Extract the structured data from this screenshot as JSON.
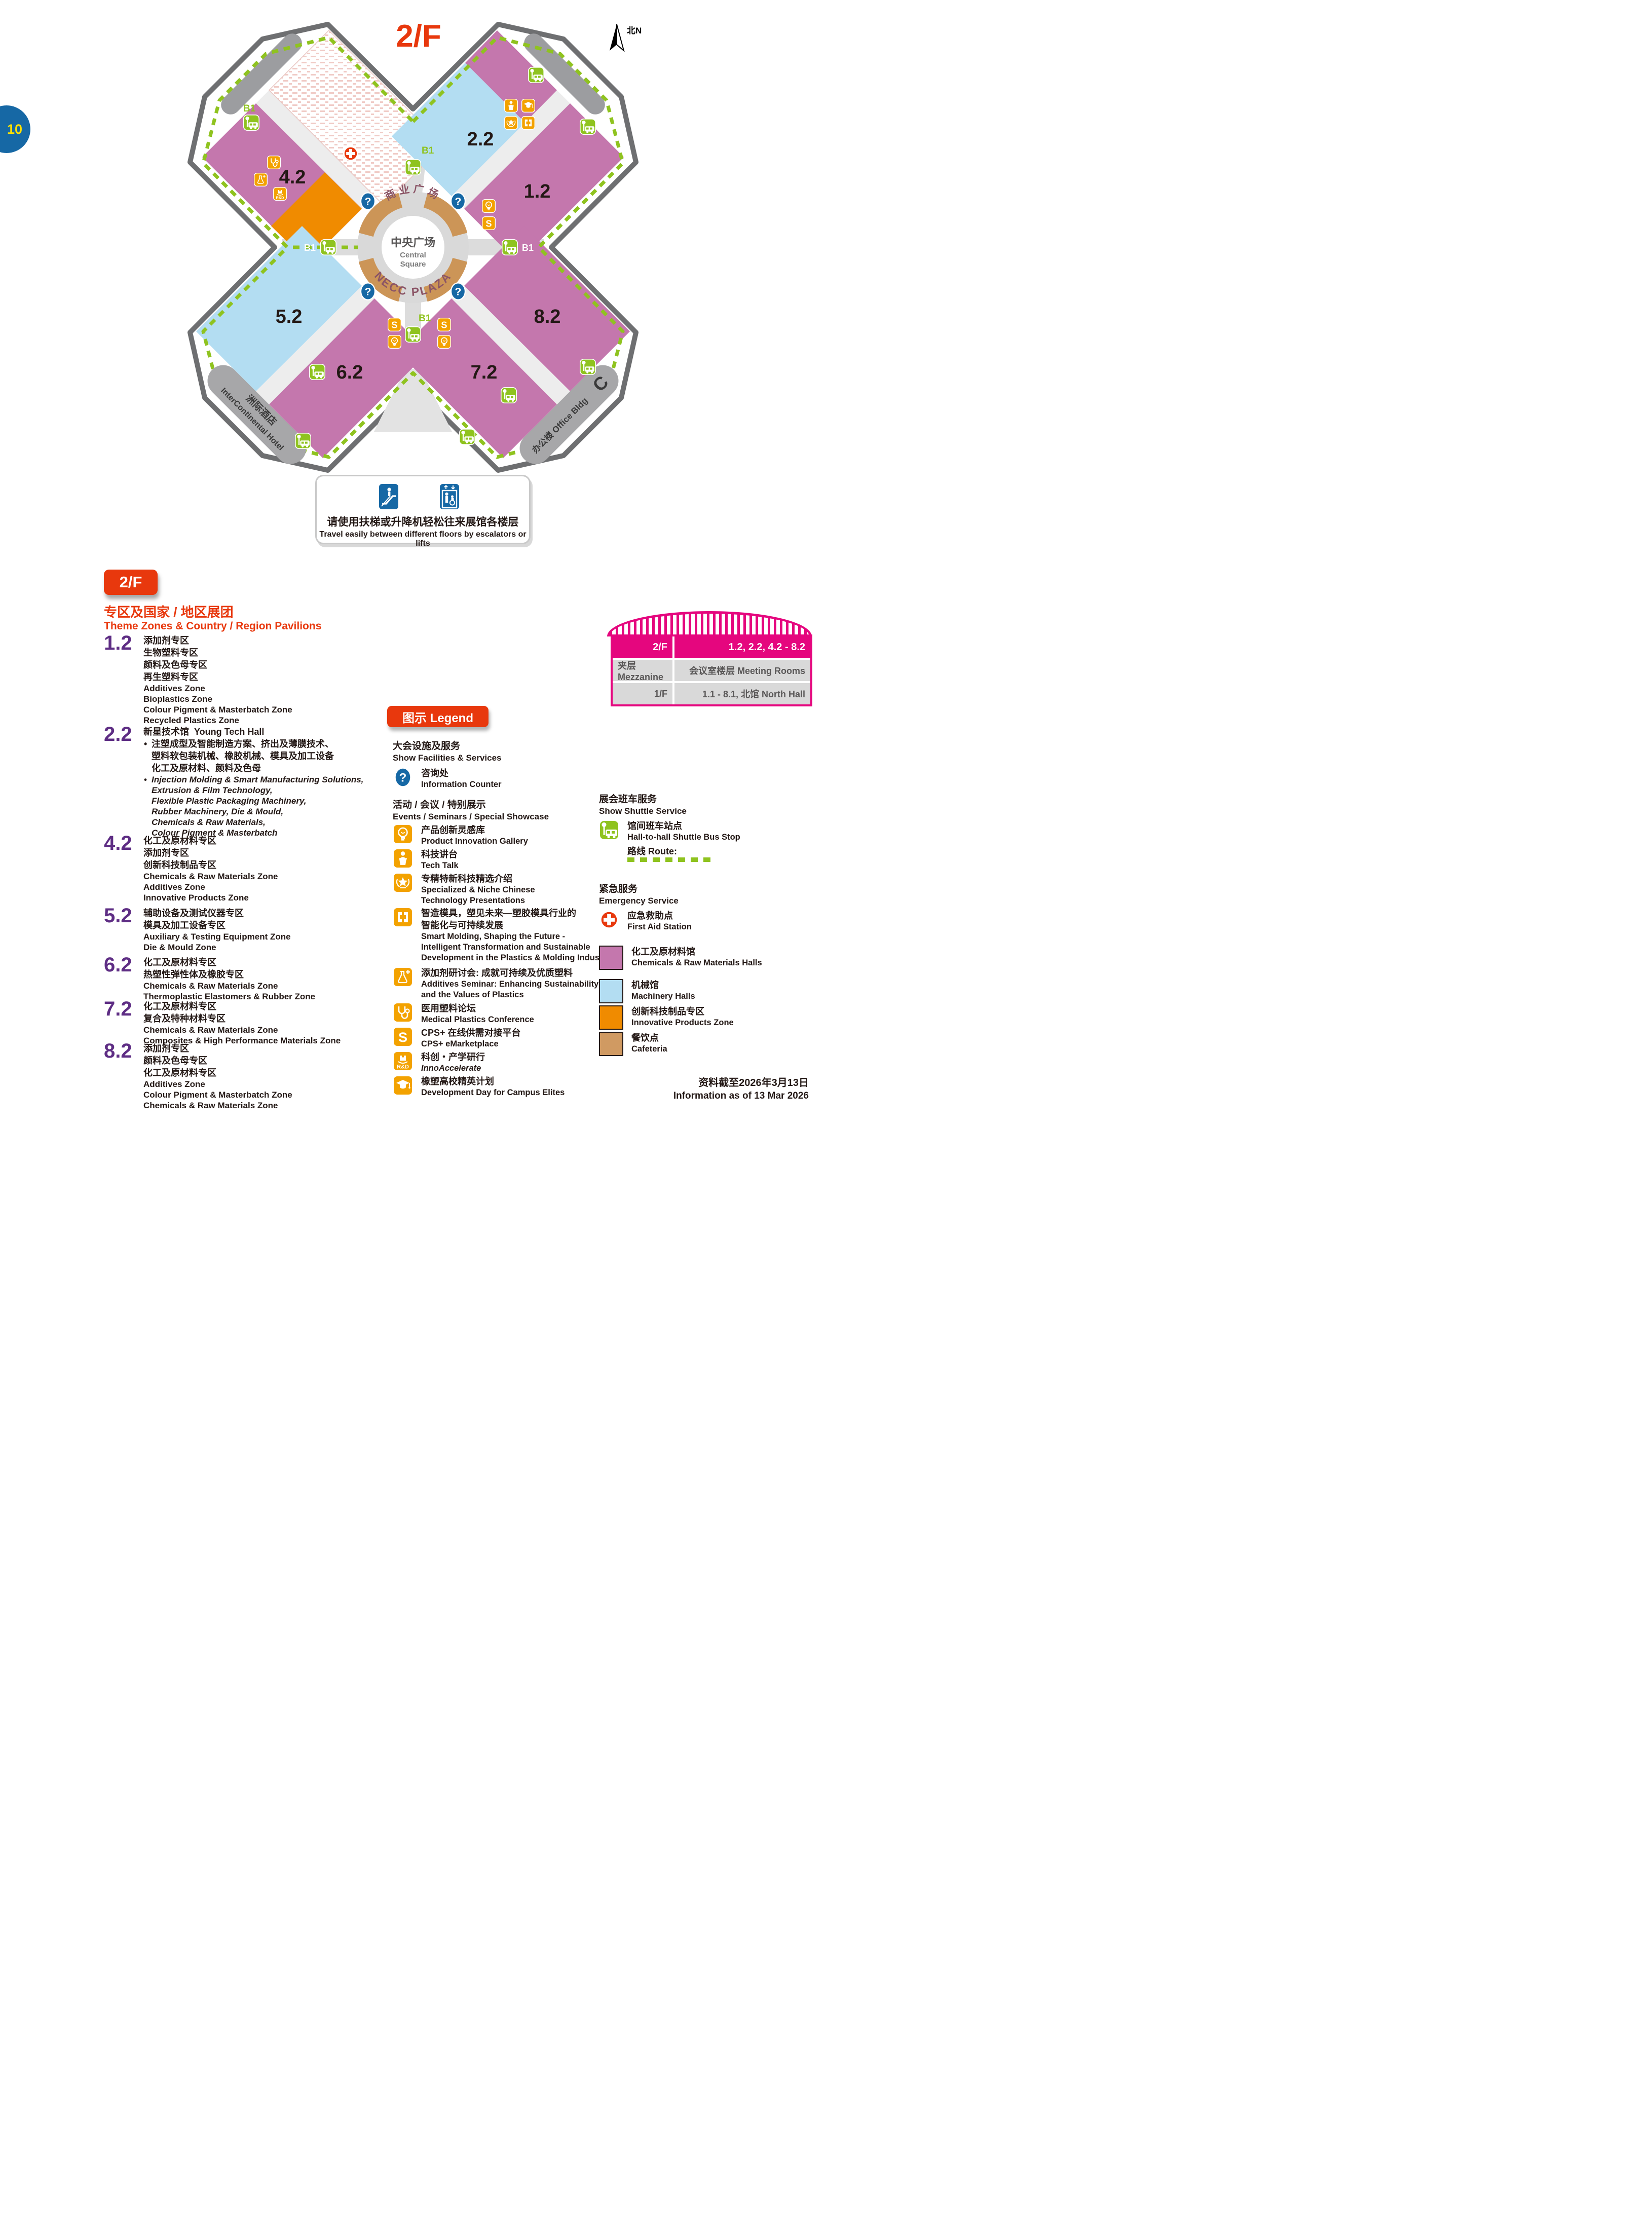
{
  "page": {
    "number": "10",
    "date_zh": "资料截至2026年3月13日",
    "date_en": "Information as of 13 Mar 2026"
  },
  "map": {
    "title": "2/F",
    "north": "北N",
    "b1": "B1",
    "halls": {
      "h12": "1.2",
      "h22": "2.2",
      "h42": "4.2",
      "h52": "5.2",
      "h62": "6.2",
      "h72": "7.2",
      "h82": "8.2"
    },
    "central": {
      "arc_top": "商业广场",
      "zh": "中央广场",
      "en1": "Central",
      "en2": "Square",
      "arc_bottom": "NECC PLAZA"
    },
    "hotel": {
      "zh": "洲际酒店",
      "en": "InterContinental Hotel"
    },
    "office": {
      "zh": "办公楼 Office Bldg",
      "letter": "C"
    }
  },
  "info_box": {
    "zh": "请使用扶梯或升降机轻松往来展馆各楼层",
    "en": "Travel easily between different floors by escalators or lifts"
  },
  "floor_badge": "2/F",
  "theme": {
    "title_zh": "专区及国家 / 地区展团",
    "title_en": "Theme Zones & Country / Region Pavilions",
    "bullet": "•",
    "zones": [
      {
        "num": "1.2",
        "zh": [
          "添加剂专区",
          "生物塑料专区",
          "颜料及色母专区",
          "再生塑料专区"
        ],
        "en": [
          "Additives Zone",
          "Bioplastics Zone",
          "Colour Pigment & Masterbatch Zone",
          "Recycled Plastics Zone"
        ]
      },
      {
        "num": "2.2",
        "title_zh": "新星技术馆",
        "title_en": "Young Tech Hall",
        "zh": [
          "注塑成型及智能制造方案、挤出及薄膜技术、",
          "塑料软包装机械、橡胶机械、模具及加工设备",
          "化工及原材料、颜料及色母"
        ],
        "en": [
          "Injection Molding & Smart Manufacturing Solutions,",
          "Extrusion & Film Technology,",
          "Flexible Plastic Packaging Machinery,",
          "Rubber Machinery, Die & Mould,",
          "Chemicals & Raw Materials,",
          "Colour Pigment & Masterbatch"
        ]
      },
      {
        "num": "4.2",
        "zh": [
          "化工及原材料专区",
          "添加剂专区",
          "创新科技制品专区"
        ],
        "en": [
          "Chemicals & Raw Materials Zone",
          "Additives Zone",
          "Innovative Products Zone"
        ]
      },
      {
        "num": "5.2",
        "zh": [
          "辅助设备及测试仪器专区",
          "模具及加工设备专区"
        ],
        "en": [
          "Auxiliary & Testing Equipment Zone",
          "Die & Mould Zone"
        ]
      },
      {
        "num": "6.2",
        "zh": [
          "化工及原材料专区",
          "热塑性弹性体及橡胶专区"
        ],
        "en": [
          "Chemicals & Raw Materials Zone",
          "Thermoplastic Elastomers & Rubber Zone"
        ]
      },
      {
        "num": "7.2",
        "zh": [
          "化工及原材料专区",
          "复合及特种材料专区"
        ],
        "en": [
          "Chemicals & Raw Materials Zone",
          "Composites & High Performance Materials Zone"
        ]
      },
      {
        "num": "8.2",
        "zh": [
          "添加剂专区",
          "颜料及色母专区",
          "化工及原材料专区"
        ],
        "en": [
          "Additives Zone",
          "Colour Pigment & Masterbatch Zone",
          "Chemicals & Raw Materials Zone"
        ]
      }
    ]
  },
  "legend": {
    "badge": "图示 Legend",
    "facilities": {
      "zh": "大会设施及服务",
      "en": "Show Facilities & Services"
    },
    "info_counter": {
      "zh": "咨询处",
      "en": "Information Counter"
    },
    "events": {
      "zh": "活动 / 会议 / 特别展示",
      "en": "Events / Seminars / Special Showcase"
    },
    "items": [
      {
        "icon": "bulb-icon",
        "zh": [
          "产品创新灵感库"
        ],
        "en": [
          "Product Innovation Gallery"
        ]
      },
      {
        "icon": "tech-talk-icon",
        "zh": [
          "科技讲台"
        ],
        "en": [
          "Tech Talk"
        ]
      },
      {
        "icon": "star-icon",
        "zh": [
          "专精特新科技精选介绍"
        ],
        "en": [
          "Specialized & Niche Chinese",
          "Technology Presentations"
        ]
      },
      {
        "icon": "mold-icon",
        "zh": [
          "智造模具，塑见未来—塑胶模具行业的",
          "智能化与可持续发展"
        ],
        "en": [
          "Smart Molding, Shaping the Future -",
          "Intelligent Transformation and Sustainable",
          "Development in the Plastics & Molding Industry"
        ]
      },
      {
        "icon": "flask-icon",
        "zh": [
          "添加剂研讨会: 成就可持续及优质塑料"
        ],
        "en": [
          "Additives Seminar: Enhancing Sustainability",
          "and the Values of Plastics"
        ]
      },
      {
        "icon": "stethoscope-icon",
        "zh": [
          "医用塑料论坛"
        ],
        "en": [
          "Medical Plastics Conference"
        ]
      },
      {
        "icon": "cps-icon",
        "zh": [
          "CPS+ 在线供需对接平台"
        ],
        "en": [
          "CPS+ eMarketplace"
        ]
      },
      {
        "icon": "rnd-icon",
        "zh": [
          "科创・产学研行"
        ],
        "en": [
          "InnoAccelerate"
        ]
      },
      {
        "icon": "grad-cap-icon",
        "zh": [
          "橡塑高校精英计划"
        ],
        "en": [
          "Development Day for Campus Elites"
        ]
      }
    ]
  },
  "shuttle": {
    "zh": "展会班车服务",
    "en": "Show Shuttle Service",
    "stop_zh": "馆间班车站点",
    "stop_en": "Hall-to-hall Shuttle Bus Stop",
    "route": "路线 Route:"
  },
  "emergency": {
    "zh": "紧急服务",
    "en": "Emergency Service",
    "firstaid_zh": "应急救助点",
    "firstaid_en": "First Aid Station"
  },
  "hall_types": [
    {
      "color": "#c477ad",
      "zh": "化工及原材料馆",
      "en": "Chemicals & Raw Materials Halls"
    },
    {
      "color": "#b3ddf2",
      "zh": "机械馆",
      "en": "Machinery Halls"
    },
    {
      "color": "#f08b00",
      "zh": "创新科技制品专区",
      "en": "Innovative Products Zone"
    },
    {
      "color": "#d09a62",
      "zh": "餐饮点",
      "en": "Cafeteria"
    }
  ],
  "floor_table": {
    "rows": [
      {
        "floor": "2/F",
        "content": "1.2, 2.2, 4.2 - 8.2"
      },
      {
        "floor": "夹层 Mezzanine",
        "content": "会议室楼层 Meeting Rooms"
      },
      {
        "floor": "1/F",
        "content": "1.1 - 8.1, 北馆 North Hall"
      }
    ]
  }
}
